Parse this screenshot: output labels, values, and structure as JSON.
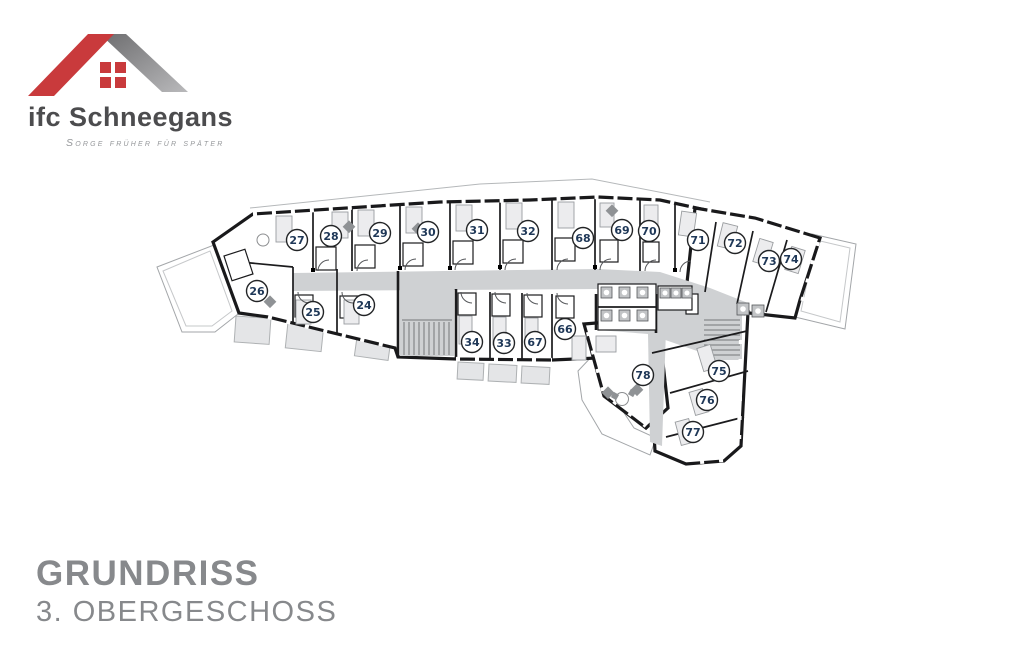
{
  "logo": {
    "brand": "ifc Schneegans",
    "tagline": "Sorge früher für später",
    "roof_red": "#c93a3c",
    "roof_gray_dark": "#6d6d6f",
    "roof_gray_light": "#b9b9bb"
  },
  "title": {
    "line1": "GRUNDRISS",
    "line2": "3.  OBERGESCHOSS",
    "color": "#87898c"
  },
  "plan": {
    "type": "floor-plan",
    "corridor_color": "#cfd1d3",
    "wall_color": "#1b1b1d",
    "badge_text_color": "#1e3757",
    "rooms": [
      {
        "number": "24",
        "x": 364,
        "y": 305
      },
      {
        "number": "25",
        "x": 313,
        "y": 312
      },
      {
        "number": "26",
        "x": 257,
        "y": 291
      },
      {
        "number": "27",
        "x": 297,
        "y": 240
      },
      {
        "number": "28",
        "x": 331,
        "y": 236
      },
      {
        "number": "29",
        "x": 380,
        "y": 233
      },
      {
        "number": "30",
        "x": 428,
        "y": 232
      },
      {
        "number": "31",
        "x": 477,
        "y": 230
      },
      {
        "number": "32",
        "x": 528,
        "y": 231
      },
      {
        "number": "33",
        "x": 504,
        "y": 343
      },
      {
        "number": "34",
        "x": 472,
        "y": 342
      },
      {
        "number": "66",
        "x": 565,
        "y": 329
      },
      {
        "number": "67",
        "x": 535,
        "y": 342
      },
      {
        "number": "68",
        "x": 583,
        "y": 238
      },
      {
        "number": "69",
        "x": 622,
        "y": 230
      },
      {
        "number": "70",
        "x": 649,
        "y": 231
      },
      {
        "number": "71",
        "x": 698,
        "y": 240
      },
      {
        "number": "72",
        "x": 735,
        "y": 243
      },
      {
        "number": "73",
        "x": 769,
        "y": 261
      },
      {
        "number": "74",
        "x": 791,
        "y": 259
      },
      {
        "number": "75",
        "x": 719,
        "y": 371
      },
      {
        "number": "76",
        "x": 707,
        "y": 400
      },
      {
        "number": "77",
        "x": 693,
        "y": 432
      },
      {
        "number": "78",
        "x": 643,
        "y": 375
      }
    ]
  }
}
